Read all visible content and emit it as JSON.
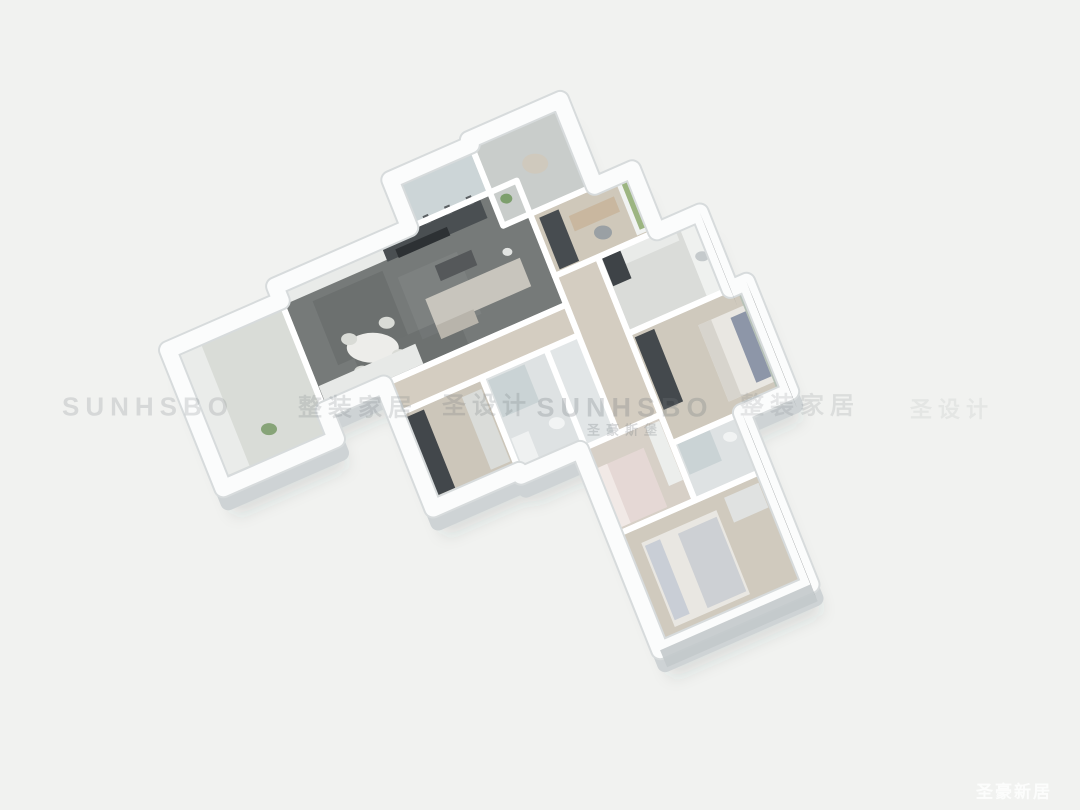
{
  "scene": {
    "type": "3d-isometric-floorplan-render",
    "background_color": "#f1f2f0",
    "shadow_color": "rgba(55,60,63,0.13)"
  },
  "watermarks": {
    "color": "#6f757a",
    "row": [
      {
        "text": "SUNHSBO",
        "x": 148,
        "y": 407,
        "size": 26,
        "opacity": 0.2
      },
      {
        "text": "整装家居",
        "x": 358,
        "y": 405,
        "size": 24,
        "opacity": 0.2
      },
      {
        "text": "圣设计",
        "x": 487,
        "y": 403,
        "size": 24,
        "opacity": 0.22
      },
      {
        "text": "SUNHSBO",
        "x": 625,
        "y": 408,
        "size": 27,
        "opacity": 0.26
      },
      {
        "text": "整装家居",
        "x": 800,
        "y": 403,
        "size": 24,
        "opacity": 0.16
      },
      {
        "text": "圣设计",
        "x": 952,
        "y": 408,
        "size": 22,
        "opacity": 0.09
      }
    ],
    "row_sub": {
      "text": "圣豪斯堡",
      "x": 625,
      "y": 429,
      "size": 13,
      "opacity": 0.26
    },
    "corner": {
      "text": "圣豪新居",
      "x": 1014,
      "y": 790,
      "size": 17,
      "opacity": 0.85,
      "color": "#ffffff"
    }
  },
  "floorplan": {
    "projection": {
      "origin": [
        162.3,
        335.7
      ],
      "u": [
        107.4,
        -47.0
      ],
      "v": [
        38.1,
        95.4
      ]
    },
    "wall": {
      "inner_color": "#ffffff",
      "inner_width": 6,
      "outer_color": "#fbfcfc",
      "outer_width": 16,
      "rim_color": "#d7dbdc",
      "extrude_fill": "#e2e6e7",
      "extrude_stroke": "#ced3d5",
      "extrude_offset": [
        5,
        14
      ],
      "shadow_offset": [
        12,
        28
      ],
      "face_offset": [
        7,
        17
      ]
    },
    "outline": [
      [
        0,
        0.15
      ],
      [
        1.05,
        0.15
      ],
      [
        1.05,
        0
      ],
      [
        2.3,
        0
      ],
      [
        2.3,
        -0.5
      ],
      [
        3.05,
        -0.5
      ],
      [
        3.05,
        -0.55
      ],
      [
        3.9,
        -0.55
      ],
      [
        3.9,
        0.35
      ],
      [
        4.25,
        0.35
      ],
      [
        4.25,
        1.0
      ],
      [
        4.65,
        1.0
      ],
      [
        4.65,
        1.8
      ],
      [
        4.8,
        1.8
      ],
      [
        4.8,
        2.95
      ],
      [
        4.35,
        2.95
      ],
      [
        4.35,
        4.75
      ],
      [
        2.95,
        4.75
      ],
      [
        2.95,
        2.65
      ],
      [
        2.4,
        2.65
      ],
      [
        2.4,
        2.6
      ],
      [
        1.6,
        2.6
      ],
      [
        1.6,
        1.3
      ],
      [
        1.05,
        1.3
      ],
      [
        1.05,
        1.6
      ],
      [
        0,
        1.6
      ]
    ],
    "rooms": [
      {
        "name": "left-balcony",
        "rect": [
          0,
          0.15,
          1.05,
          1.6
        ],
        "floor": "#d9dcd7"
      },
      {
        "name": "living-dining",
        "rect": [
          1.05,
          0,
          3.3,
          1.3
        ],
        "floor": "#767a79"
      },
      {
        "name": "top-balcony",
        "rect": [
          2.3,
          -0.5,
          3.05,
          0
        ],
        "floor": "#ccd5d7"
      },
      {
        "name": "entry",
        "rect": [
          3.05,
          -0.55,
          3.9,
          0.35
        ],
        "floor": "#c9cdcb"
      },
      {
        "name": "study",
        "rect": [
          3.3,
          0.35,
          4.25,
          1.0
        ],
        "floor": "#cfc8ba"
      },
      {
        "name": "kitchen",
        "rect": [
          3.7,
          1.0,
          4.65,
          1.8
        ],
        "floor": "#dadcd9"
      },
      {
        "name": "corridor",
        "rect": [
          3.3,
          1.0,
          3.7,
          2.65
        ],
        "floor": "#d4cdc1"
      },
      {
        "name": "hallway",
        "rect": [
          1.6,
          1.3,
          3.3,
          1.62
        ],
        "floor": "#d4cdc1"
      },
      {
        "name": "wardrobe-room",
        "rect": [
          1.6,
          1.62,
          2.4,
          2.6
        ],
        "floor": "#ccc6ba"
      },
      {
        "name": "bathroom-1",
        "rect": [
          2.4,
          1.62,
          3.0,
          2.65
        ],
        "floor": "#dee2e3"
      },
      {
        "name": "kids-bedroom",
        "rect": [
          2.95,
          2.65,
          3.7,
          3.55
        ],
        "floor": "#d7d0c7"
      },
      {
        "name": "bedroom-right",
        "rect": [
          3.7,
          1.8,
          4.8,
          2.95
        ],
        "floor": "#cfc9bd"
      },
      {
        "name": "bathroom-2",
        "rect": [
          3.7,
          2.95,
          4.35,
          3.55
        ],
        "floor": "#dee2e3"
      },
      {
        "name": "master-bedroom",
        "rect": [
          2.95,
          3.55,
          4.35,
          4.75
        ],
        "floor": "#d0cabe"
      }
    ],
    "furniture": [
      {
        "room": "living-dining",
        "name": "wall-cabinets",
        "type": "rect",
        "rect": [
          1.08,
          0.02,
          2.02,
          0.2
        ],
        "color": "#e9ebe9"
      },
      {
        "room": "living-dining",
        "name": "tv-wall-shelving",
        "type": "rect",
        "rect": [
          2.02,
          0.02,
          2.95,
          0.22
        ],
        "color": "#4a4f52"
      },
      {
        "room": "living-dining",
        "name": "tv-screen",
        "type": "rect",
        "rect": [
          2.12,
          0.14,
          2.6,
          0.23
        ],
        "color": "#2d3134"
      },
      {
        "room": "living-dining",
        "name": "marble-streak-1",
        "type": "rect",
        "rect": [
          1.3,
          0.28,
          1.95,
          0.95
        ],
        "color": "#565a5b",
        "opacity": 0.3
      },
      {
        "room": "living-dining",
        "name": "marble-streak-2",
        "type": "rect",
        "rect": [
          2.05,
          0.4,
          2.6,
          1.05
        ],
        "color": "#8e9293",
        "opacity": 0.28
      },
      {
        "room": "living-dining",
        "name": "marble-streak-3",
        "type": "rect",
        "rect": [
          1.45,
          0.95,
          2.4,
          1.27
        ],
        "color": "#4e5253",
        "opacity": 0.22
      },
      {
        "room": "living-dining",
        "name": "sofa",
        "type": "rect",
        "rect": [
          2.2,
          0.7,
          3.08,
          1.0
        ],
        "color": "#c8c5bd"
      },
      {
        "room": "living-dining",
        "name": "sofa-chaise",
        "type": "rect",
        "rect": [
          2.2,
          0.98,
          2.55,
          1.12
        ],
        "color": "#b8b4ab"
      },
      {
        "room": "living-dining",
        "name": "coffee-table",
        "type": "rect",
        "rect": [
          2.38,
          0.44,
          2.72,
          0.6
        ],
        "color": "#55585a"
      },
      {
        "room": "living-dining",
        "name": "dining-table",
        "type": "ellipse",
        "at": [
          1.63,
          0.93
        ],
        "rx": 26,
        "ry": 15,
        "color": "#ededea"
      },
      {
        "room": "living-dining",
        "name": "dining-chair",
        "type": "ellipse",
        "at": [
          1.47,
          0.76
        ],
        "rx": 8,
        "ry": 6,
        "color": "#d9dbd6"
      },
      {
        "room": "living-dining",
        "name": "dining-chair",
        "type": "ellipse",
        "at": [
          1.82,
          0.76
        ],
        "rx": 8,
        "ry": 6,
        "color": "#d9dbd6"
      },
      {
        "room": "living-dining",
        "name": "dining-chair",
        "type": "ellipse",
        "at": [
          1.47,
          1.1
        ],
        "rx": 8,
        "ry": 6,
        "color": "#d9dbd6"
      },
      {
        "room": "living-dining",
        "name": "dining-chair",
        "type": "ellipse",
        "at": [
          1.82,
          1.1
        ],
        "rx": 8,
        "ry": 6,
        "color": "#d9dbd6"
      },
      {
        "room": "living-dining",
        "name": "sideboard",
        "type": "rect",
        "rect": [
          1.08,
          1.06,
          1.98,
          1.27
        ],
        "color": "#e7e9e7"
      },
      {
        "room": "living-dining",
        "name": "floor-lamp",
        "type": "ellipse",
        "at": [
          3.0,
          0.6
        ],
        "rx": 5,
        "ry": 4,
        "color": "#e2e4e2"
      },
      {
        "room": "left-balcony",
        "name": "storage-cabinet",
        "type": "rect",
        "rect": [
          0.05,
          0.22,
          0.28,
          1.5
        ],
        "color": "#eaecea"
      },
      {
        "room": "left-balcony",
        "name": "plant",
        "type": "ellipse",
        "at": [
          0.55,
          1.25
        ],
        "rx": 8,
        "ry": 6,
        "color": "#87a478"
      },
      {
        "room": "top-balcony",
        "name": "glass-door-mullion",
        "type": "rect",
        "rect": [
          2.44,
          -0.05,
          2.49,
          0.04
        ],
        "color": "#5c6164"
      },
      {
        "room": "top-balcony",
        "name": "glass-door-mullion",
        "type": "rect",
        "rect": [
          2.64,
          -0.05,
          2.69,
          0.04
        ],
        "color": "#5c6164"
      },
      {
        "room": "top-balcony",
        "name": "glass-door-mullion",
        "type": "rect",
        "rect": [
          2.84,
          -0.05,
          2.89,
          0.04
        ],
        "color": "#5c6164"
      },
      {
        "room": "entry",
        "name": "armchair",
        "type": "ellipse",
        "at": [
          3.5,
          -0.08
        ],
        "rx": 13,
        "ry": 10,
        "color": "#cfc9bd"
      },
      {
        "room": "entry",
        "name": "plant",
        "type": "ellipse",
        "at": [
          3.16,
          0.12
        ],
        "rx": 6,
        "ry": 5,
        "color": "#7d9f6d"
      },
      {
        "room": "study",
        "name": "bookshelf",
        "type": "rect",
        "rect": [
          3.36,
          0.42,
          3.54,
          0.96
        ],
        "color": "#474c50"
      },
      {
        "room": "study",
        "name": "window-frame",
        "type": "rect",
        "rect": [
          4.08,
          0.4,
          4.24,
          0.96
        ],
        "color": "#f1f3f2"
      },
      {
        "room": "study",
        "name": "window-greenery",
        "type": "rect",
        "rect": [
          4.12,
          0.44,
          4.23,
          0.92
        ],
        "color": "#9cb581"
      },
      {
        "room": "study",
        "name": "desk",
        "type": "rect",
        "rect": [
          3.6,
          0.52,
          4.02,
          0.68
        ],
        "color": "#c9b79f"
      },
      {
        "room": "study",
        "name": "desk-chair",
        "type": "ellipse",
        "at": [
          3.82,
          0.8
        ],
        "rx": 9,
        "ry": 7,
        "color": "#9aa0a4"
      },
      {
        "room": "kitchen",
        "name": "counter-right",
        "type": "rect",
        "rect": [
          4.44,
          1.04,
          4.63,
          1.77
        ],
        "color": "#eff1ef"
      },
      {
        "room": "kitchen",
        "name": "counter-top",
        "type": "rect",
        "rect": [
          3.73,
          1.02,
          4.4,
          1.17
        ],
        "color": "#e9ebe9"
      },
      {
        "room": "kitchen",
        "name": "tall-unit",
        "type": "rect",
        "rect": [
          3.73,
          1.02,
          3.9,
          1.32
        ],
        "color": "#3e4347"
      },
      {
        "room": "kitchen",
        "name": "sink",
        "type": "ellipse",
        "at": [
          4.53,
          1.4
        ],
        "rx": 7,
        "ry": 5,
        "color": "#c5cacc"
      },
      {
        "room": "bedroom-right",
        "name": "headboard-wall",
        "type": "rect",
        "rect": [
          4.7,
          1.83,
          4.8,
          2.93
        ],
        "color": "#b6c1b7"
      },
      {
        "room": "bedroom-right",
        "name": "bed",
        "type": "rect",
        "rect": [
          4.28,
          2.0,
          4.7,
          2.8
        ],
        "color": "#e9e7e2"
      },
      {
        "room": "bedroom-right",
        "name": "pillows",
        "type": "rect",
        "rect": [
          4.56,
          2.06,
          4.7,
          2.74
        ],
        "color": "#8d96a8"
      },
      {
        "room": "bedroom-right",
        "name": "blanket",
        "type": "rect",
        "rect": [
          4.28,
          2.0,
          4.4,
          2.8
        ],
        "color": "#d7d4cd"
      },
      {
        "room": "bedroom-right",
        "name": "wardrobe",
        "type": "rect",
        "rect": [
          3.74,
          1.86,
          3.92,
          2.62
        ],
        "color": "#44494d"
      },
      {
        "room": "wardrobe-room",
        "name": "wardrobe-dark",
        "type": "rect",
        "rect": [
          1.65,
          1.68,
          1.84,
          2.5
        ],
        "color": "#42474b"
      },
      {
        "room": "wardrobe-room",
        "name": "shelving",
        "type": "rect",
        "rect": [
          2.18,
          1.72,
          2.36,
          2.48
        ],
        "color": "#dadcd9"
      },
      {
        "room": "bathroom-1",
        "name": "shower-glass",
        "type": "rect",
        "rect": [
          2.44,
          1.67,
          2.78,
          2.06
        ],
        "color": "#bfcbce",
        "opacity": 0.65
      },
      {
        "room": "bathroom-1",
        "name": "vanity",
        "type": "rect",
        "rect": [
          2.44,
          2.28,
          2.6,
          2.58
        ],
        "color": "#eff1f1"
      },
      {
        "room": "bathroom-1",
        "name": "toilet",
        "type": "ellipse",
        "at": [
          2.85,
          2.32
        ],
        "rx": 8,
        "ry": 6,
        "color": "#f2f4f4"
      },
      {
        "room": "kids-bedroom",
        "name": "bed",
        "type": "rect",
        "rect": [
          3.0,
          2.88,
          3.46,
          3.5
        ],
        "color": "#e5d8d5"
      },
      {
        "room": "kids-bedroom",
        "name": "pillow",
        "type": "rect",
        "rect": [
          3.0,
          2.88,
          3.12,
          3.5
        ],
        "color": "#f1e9e6"
      },
      {
        "room": "kids-bedroom",
        "name": "wardrobe",
        "type": "rect",
        "rect": [
          3.54,
          2.7,
          3.67,
          3.32
        ],
        "color": "#eceeec"
      },
      {
        "room": "bathroom-2",
        "name": "shower-glass",
        "type": "rect",
        "rect": [
          3.74,
          2.98,
          4.04,
          3.3
        ],
        "color": "#bfcbce",
        "opacity": 0.65
      },
      {
        "room": "bathroom-2",
        "name": "toilet",
        "type": "ellipse",
        "at": [
          4.18,
          3.12
        ],
        "rx": 7,
        "ry": 5,
        "color": "#f1f3f3"
      },
      {
        "room": "master-bedroom",
        "name": "bed",
        "type": "rect",
        "rect": [
          3.14,
          3.72,
          3.84,
          4.6
        ],
        "color": "#e9e7e2"
      },
      {
        "room": "master-bedroom",
        "name": "pillows",
        "type": "rect",
        "rect": [
          3.16,
          3.76,
          3.3,
          4.54
        ],
        "color": "#c9ced6"
      },
      {
        "room": "master-bedroom",
        "name": "blanket",
        "type": "rect",
        "rect": [
          3.46,
          3.78,
          3.82,
          4.56
        ],
        "color": "#cdd0d4"
      },
      {
        "room": "master-bedroom",
        "name": "dresser",
        "type": "rect",
        "rect": [
          3.94,
          3.64,
          4.26,
          3.9
        ],
        "color": "#e0e2e1"
      }
    ],
    "wallfaces": [
      {
        "from": [
          4.65,
          1.0
        ],
        "to": [
          4.65,
          1.8
        ],
        "color": "#3a3f43",
        "opacity": 0.75
      },
      {
        "from": [
          4.8,
          1.8
        ],
        "to": [
          4.8,
          2.95
        ],
        "color": "#33383b",
        "opacity": 0.85
      },
      {
        "from": [
          4.35,
          2.95
        ],
        "to": [
          4.35,
          4.75
        ],
        "color": "#2f3437",
        "opacity": 0.85
      },
      {
        "from": [
          2.95,
          4.75
        ],
        "to": [
          4.35,
          4.75
        ],
        "color": "#c3c9cb",
        "opacity": 0.9
      }
    ]
  }
}
